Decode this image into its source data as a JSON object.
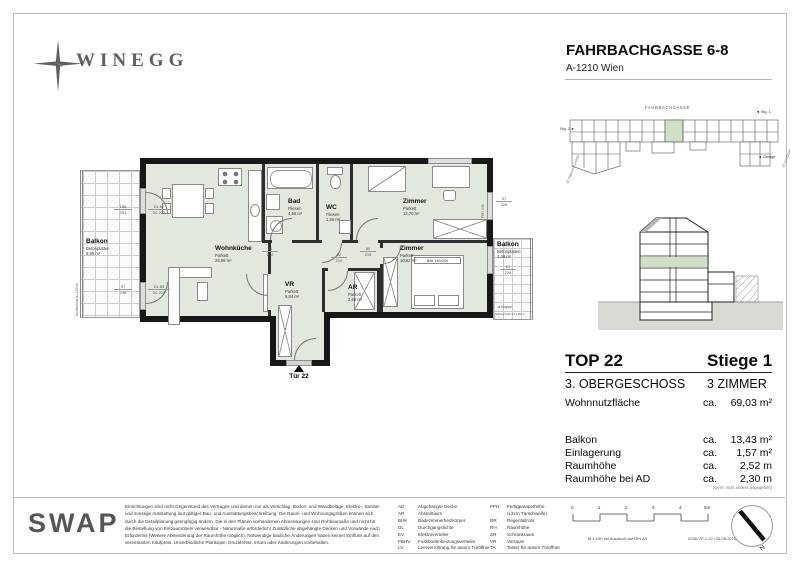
{
  "header": {
    "brand": "WINEGG",
    "project": "FAHRBACHGASSE 6-8",
    "address": "A-1210 Wien"
  },
  "plan": {
    "entrance_label": "Tür 22",
    "rooms": {
      "balkon_links": {
        "name": "Balkon",
        "finish": "Betonplatten",
        "area": "9,95 m²"
      },
      "wohnkueche": {
        "name": "Wohnküche",
        "finish": "Parkett",
        "area": "26,99 m²"
      },
      "bad": {
        "name": "Bad",
        "finish": "Fliesen",
        "area": "4,66 m²"
      },
      "wc": {
        "name": "WC",
        "finish": "Fliesen",
        "area": "1,56 m²"
      },
      "zimmer_oben": {
        "name": "Zimmer",
        "finish": "Parkett",
        "area": "12,70 m²"
      },
      "zimmer_mitte": {
        "name": "Zimmer",
        "finish": "Parkett",
        "area": "10,62 m²"
      },
      "ar": {
        "name": "AR",
        "finish": "Parkett",
        "area": "2,66 m²"
      },
      "vr": {
        "name": "VR",
        "finish": "Parkett",
        "area": "9,84 m²"
      },
      "balkon_rechts": {
        "name": "Balkon",
        "finish": "Betonplatten",
        "area": "3,48 m²"
      }
    },
    "furniture": {
      "bett": "Bett 140x200"
    },
    "dims": {
      "d1": "186",
      "d1b": "251",
      "d2": "DL 82",
      "d2b": "DL 222",
      "d3": "97",
      "d3b": "236",
      "d4": "DL 83",
      "d4b": "DL 219",
      "d5": "97",
      "d5b": "226",
      "d6": "97",
      "d6b": "226",
      "d7": "80",
      "d7b": "210",
      "d8": "80",
      "d8b": "219",
      "d9": "62",
      "d9b": "210",
      "fph": "FPH 0,90"
    },
    "annotations": {
      "klappe": "◄ Klappe",
      "sichtschutz_r": "Sichtschutz b=1,20 m",
      "sichtschutz_l": "Sichtschutz b=1,60 m"
    }
  },
  "siteplan": {
    "street_top": "FAHRBACHGASSE",
    "stg1": "◄ Stg. 1",
    "stg2": "Stg. 2 ►",
    "garage": "◄ Garage",
    "street_left": "SCHWAIGERGASSE",
    "street_right": "SCHLOSSHOFER STRASSE"
  },
  "info": {
    "top": "TOP 22",
    "stiege": "Stiege 1",
    "geschoss": "3. OBERGESCHOSS",
    "zimmer": "3 ZIMMER",
    "rows": [
      {
        "label": "Wohnnutzfläche",
        "ca": "ca.",
        "value": "69,03 m²"
      },
      {
        "label": "Balkon",
        "ca": "ca.",
        "value": "13,43 m²"
      },
      {
        "label": "Einlagerung",
        "ca": "ca.",
        "value": "1,57 m²"
      },
      {
        "label": "Raumhöhe",
        "ca": "ca.",
        "value": "2,52 m"
      },
      {
        "label": "Raumhöhe bei AD",
        "ca": "ca.",
        "value": "2,30 m"
      }
    ],
    "note": "(wenn nicht anders angegeben)"
  },
  "footer": {
    "brand": "SWAP",
    "disclaimer": "Einrichtungen sind nicht Gegenstand des Vertrages und dienen nur als Vorschlag. Boden- und Wandbeläge, Elektro-, Sanitär-\nund sonstige Ausstattung laut gültiger Bau- und Ausstattungsbeschreibung. Die Raum- und Wohnungsgrößen können sich\ndurch die Detailplanung geringfügig ändern. Die in den Plänen vorhandenen Abmessungen sind Rohbaumaße und nicht für\ndie Bestellung von Einbaumöbeln verwendbar - Naturmaße erforderlich! Zusätzliche abgehängte Decken und Vorwände nach\nErfordernis (Weitere Abminderung der Raumhöhe möglich). Notwendige bauliche Änderungen haben keinen Einfluss auf den\nvereinbarten Kaufpreis. Unverbindliche Plankopie, Druckfehler, Irrtum oder Änderungen vorbehalten.",
    "abbr_left": [
      [
        "AD",
        "Abgehängte Decke"
      ],
      [
        "AR",
        "Abstellraum"
      ],
      [
        "BHK",
        "Badezimmerheizkörper"
      ],
      [
        "DL",
        "Durchgangslichte"
      ],
      [
        "EV",
        "Elektroverteiler"
      ],
      [
        "FBHV",
        "Fussbodenheizungsverteiler"
      ],
      [
        "LV",
        "Leerverrohrung für autom.Türöffner"
      ]
    ],
    "abbr_right": [
      [
        "FPH",
        "Fertigparapethöhe"
      ],
      [
        "",
        "(±3cm Türschwelle)"
      ],
      [
        "RR",
        "Regenfallrohr"
      ],
      [
        "RH",
        "Raumhöhe"
      ],
      [
        "SR",
        "Schrankraum"
      ],
      [
        "VR",
        "Vorraum"
      ],
      [
        "TA",
        "Taster für autom.Türöffner"
      ]
    ],
    "scale_labels": [
      "0",
      "1",
      "2",
      "3",
      "4",
      "5m"
    ],
    "print_scale": "M 1:100 bei Ausdruck auf DIN A4",
    "doc_code": "0238-VP-1.22 | 25.08.2023",
    "north": "N"
  }
}
